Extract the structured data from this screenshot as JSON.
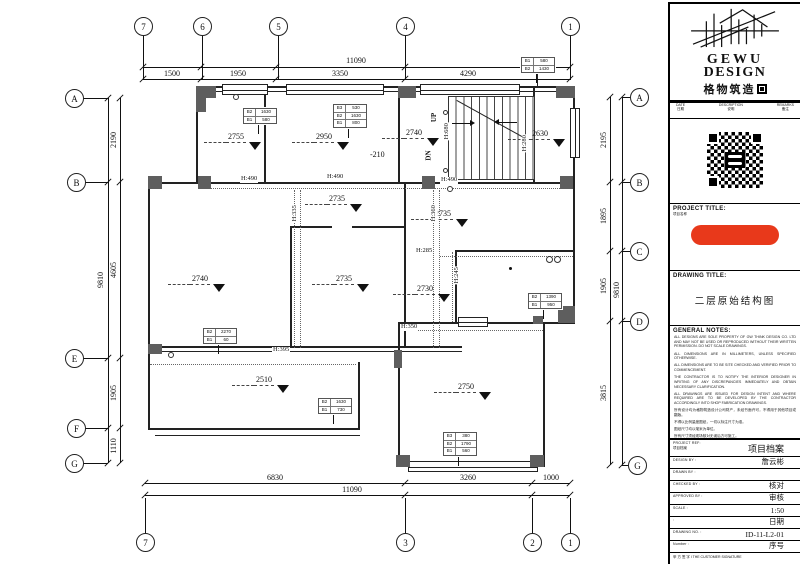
{
  "title_block": {
    "logo": {
      "en1": "GEWU",
      "en2": "DESIGN",
      "cn": "格物筑造"
    },
    "revision_header": [
      {
        "en": "DATE",
        "cn": "日期"
      },
      {
        "en": "DESCRIPTION",
        "cn": "说明"
      },
      {
        "en": "REMARKS",
        "cn": "备注"
      }
    ],
    "project_title": {
      "label": "PROJECT TITLE:",
      "sub": "项目名称"
    },
    "drawing_title": {
      "label": "DRAWING  TITLE:",
      "value": "二层原始结构图"
    },
    "general_notes": {
      "label": "GENERAL NOTES:",
      "notes_en": [
        "ALL DESIGNS ARE SOLE PROPERTY OF GW THINK DESIGN CO. LTD AND MAY NOT BE USED OR REPRODUCED WITHOUT THEIR WRITTEN PERMISSION. DO NOT SCALE DRAWINGS.",
        "ALL DIMENSIONS ARE IN MILLIMETERS, UNLESS SPECIFIED OTHERWISE.",
        "ALL DIMENSIONS ARE TO BE SITE CHECKED AND VERIFIED PRIOR TO COMMENCEMENT.",
        "THE CONTRACTOR IS TO NOTIFY THE INTERIOR DESIGNER IN WRITING OF ANY DISCREPANCIES IMMEDIATELY AND OBTAIN NECESSARY CLARIFICATION.",
        "ALL DRAWINGS ARE ISSUED FOR DESIGN INTENT AND WHERE REQUIRED ARE TO BE DEVELOPED BY THE CONTRACTOR ACCORDINGLY INTO SHOP FABRICATION DRAWINGS."
      ],
      "notes_cn": [
        "所有设计均为格物筑造设计公司财产，未经书面许可，不得用于其他项目或翻版。",
        "不得以比例量度图纸，一切以标注尺寸为准。",
        "图纸尺寸均以毫米为单位。",
        "所有尺寸须经现场核对无误后方可施工。",
        "如有疑问，承建商须立即以书面通知设计师并取得必要之说明。",
        "所有图纸仅作设计意向，承建商须按需要深化为加工图。"
      ]
    },
    "fields": [
      {
        "label": "PROJECT REF:",
        "sub": "项目档案",
        "value": "项目档案",
        "big": true
      },
      {
        "label": "DESIGN BY :",
        "value": "詹云彬"
      },
      {
        "label": "DRAWN BY :",
        "value": ""
      },
      {
        "label": "CHECKED BY :",
        "value": "核对"
      },
      {
        "label": "APPROVED BY :",
        "value": "审核"
      },
      {
        "label": "SCALE :",
        "value": "1:50"
      },
      {
        "label": ":",
        "value": "日期"
      },
      {
        "label": "DRAWING NO. :",
        "value": "ID-11-L2-01"
      },
      {
        "label": "Number :",
        "value": "序号"
      }
    ],
    "signature": "甲 方 签 字 l THE CUSTOMER SIGNATURE"
  },
  "plan": {
    "grid_bubbles": [
      {
        "label": "7",
        "x": 143,
        "y": 26,
        "side": "top"
      },
      {
        "label": "6",
        "x": 202,
        "y": 26,
        "side": "top"
      },
      {
        "label": "5",
        "x": 278,
        "y": 26,
        "side": "top"
      },
      {
        "label": "4",
        "x": 405,
        "y": 26,
        "side": "top"
      },
      {
        "label": "1",
        "x": 570,
        "y": 26,
        "side": "top"
      },
      {
        "label": "A",
        "x": 74,
        "y": 98,
        "side": "left"
      },
      {
        "label": "B",
        "x": 76,
        "y": 182,
        "side": "left"
      },
      {
        "label": "E",
        "x": 74,
        "y": 358,
        "side": "left"
      },
      {
        "label": "F",
        "x": 76,
        "y": 428,
        "side": "left"
      },
      {
        "label": "G",
        "x": 74,
        "y": 463,
        "side": "left"
      },
      {
        "label": "A",
        "x": 639,
        "y": 97,
        "side": "right"
      },
      {
        "label": "B",
        "x": 639,
        "y": 182,
        "side": "right"
      },
      {
        "label": "C",
        "x": 639,
        "y": 251,
        "side": "right"
      },
      {
        "label": "D",
        "x": 639,
        "y": 321,
        "side": "right"
      },
      {
        "label": "G",
        "x": 637,
        "y": 465,
        "side": "right"
      },
      {
        "label": "7",
        "x": 145,
        "y": 542,
        "side": "bottom"
      },
      {
        "label": "3",
        "x": 405,
        "y": 542,
        "side": "bottom"
      },
      {
        "label": "2",
        "x": 532,
        "y": 542,
        "side": "bottom"
      },
      {
        "label": "1",
        "x": 570,
        "y": 542,
        "side": "bottom"
      }
    ],
    "dimensions": [
      {
        "value": "11090",
        "x": 356,
        "y": 61,
        "rot": false
      },
      {
        "value": "1500",
        "x": 172,
        "y": 74,
        "rot": false
      },
      {
        "value": "1950",
        "x": 238,
        "y": 74,
        "rot": false
      },
      {
        "value": "3350",
        "x": 340,
        "y": 74,
        "rot": false
      },
      {
        "value": "4290",
        "x": 468,
        "y": 74,
        "rot": false
      },
      {
        "value": "6830",
        "x": 275,
        "y": 478,
        "rot": false
      },
      {
        "value": "3260",
        "x": 468,
        "y": 478,
        "rot": false
      },
      {
        "value": "1000",
        "x": 551,
        "y": 478,
        "rot": false
      },
      {
        "value": "11090",
        "x": 352,
        "y": 490,
        "rot": false
      },
      {
        "value": "9810",
        "x": 101,
        "y": 280,
        "rot": true
      },
      {
        "value": "2190",
        "x": 114,
        "y": 140,
        "rot": true
      },
      {
        "value": "4605",
        "x": 114,
        "y": 270,
        "rot": true
      },
      {
        "value": "1905",
        "x": 114,
        "y": 393,
        "rot": true
      },
      {
        "value": "1110",
        "x": 114,
        "y": 446,
        "rot": true
      },
      {
        "value": "2195",
        "x": 604,
        "y": 140,
        "rot": true
      },
      {
        "value": "1895",
        "x": 604,
        "y": 216,
        "rot": true
      },
      {
        "value": "1905",
        "x": 604,
        "y": 286,
        "rot": true
      },
      {
        "value": "3815",
        "x": 604,
        "y": 393,
        "rot": true
      },
      {
        "value": "9810",
        "x": 617,
        "y": 290,
        "rot": true
      }
    ],
    "elevation_markers": [
      {
        "value": "2755",
        "x": 204,
        "y": 133,
        "dash": true,
        "tri": true
      },
      {
        "value": "2950",
        "x": 292,
        "y": 133,
        "dash": true,
        "tri": true
      },
      {
        "value": "-210",
        "x": 370,
        "y": 151,
        "dash": false,
        "tri": false
      },
      {
        "value": "2740",
        "x": 382,
        "y": 129,
        "dash": true,
        "tri": true
      },
      {
        "value": "2630",
        "x": 508,
        "y": 130,
        "dash": true,
        "tri": true
      },
      {
        "value": "2735",
        "x": 305,
        "y": 195,
        "dash": true,
        "tri": true
      },
      {
        "value": "2735",
        "x": 411,
        "y": 210,
        "dash": true,
        "tri": true
      },
      {
        "value": "2735",
        "x": 312,
        "y": 275,
        "dash": true,
        "tri": true
      },
      {
        "value": "2730",
        "x": 393,
        "y": 285,
        "dash": true,
        "tri": true
      },
      {
        "value": "2740",
        "x": 168,
        "y": 275,
        "dash": true,
        "tri": true
      },
      {
        "value": "2510",
        "x": 232,
        "y": 376,
        "dash": true,
        "tri": true
      },
      {
        "value": "2750",
        "x": 434,
        "y": 383,
        "dash": true,
        "tri": true
      }
    ],
    "height_labels": [
      {
        "text": "H:490",
        "x": 240,
        "y": 176,
        "rot": false
      },
      {
        "text": "H:490",
        "x": 326,
        "y": 174,
        "rot": false
      },
      {
        "text": "H:490",
        "x": 440,
        "y": 177,
        "rot": false
      },
      {
        "text": "H:395",
        "x": 272,
        "y": 347,
        "rot": false
      },
      {
        "text": "H:285",
        "x": 415,
        "y": 248,
        "rot": false
      },
      {
        "text": "H:350",
        "x": 400,
        "y": 324,
        "rot": false
      },
      {
        "text": "H:335",
        "x": 286,
        "y": 210,
        "rot": true
      },
      {
        "text": "H:360",
        "x": 425,
        "y": 210,
        "rot": true
      },
      {
        "text": "H:680",
        "x": 438,
        "y": 128,
        "rot": true
      },
      {
        "text": "H:280",
        "x": 516,
        "y": 140,
        "rot": true
      },
      {
        "text": "H:245",
        "x": 448,
        "y": 272,
        "rot": true
      }
    ],
    "stair": {
      "up_label": "UP",
      "dn_label": "DN"
    },
    "tags": [
      {
        "x": 243,
        "y": 108,
        "rows": [
          [
            "B2",
            "1630"
          ],
          [
            "B1",
            "580"
          ]
        ]
      },
      {
        "x": 333,
        "y": 104,
        "rows": [
          [
            "B3",
            "530"
          ],
          [
            "B2",
            "1630"
          ],
          [
            "B1",
            "800"
          ]
        ]
      },
      {
        "x": 521,
        "y": 57,
        "rows": [
          [
            "B1",
            "580"
          ],
          [
            "B2",
            "1430"
          ]
        ]
      },
      {
        "x": 203,
        "y": 328,
        "rows": [
          [
            "B2",
            "2270"
          ],
          [
            "B1",
            "60"
          ]
        ]
      },
      {
        "x": 318,
        "y": 398,
        "rows": [
          [
            "B2",
            "1630"
          ],
          [
            "B1",
            "730"
          ]
        ]
      },
      {
        "x": 528,
        "y": 293,
        "rows": [
          [
            "B2",
            "1390"
          ],
          [
            "B1",
            "950"
          ]
        ]
      },
      {
        "x": 443,
        "y": 432,
        "rows": [
          [
            "B3",
            "380"
          ],
          [
            "B2",
            "1790"
          ],
          [
            "B1",
            "560"
          ]
        ]
      }
    ]
  }
}
